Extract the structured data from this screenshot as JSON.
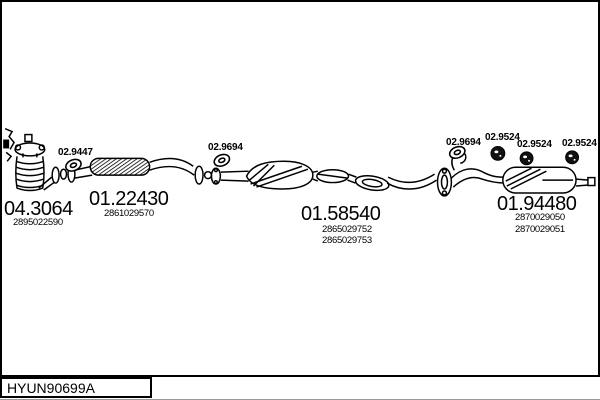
{
  "diagram_code": "HYUN90699A",
  "colors": {
    "line": "#000000",
    "background": "#ffffff"
  },
  "parts": {
    "catalyst": {
      "number": "04.3064",
      "oem": "2895022590"
    },
    "front_pipe": {
      "number": "01.22430",
      "oem": "2861029570"
    },
    "centre_silencer": {
      "number": "01.58540",
      "oem_a": "2865029752",
      "oem_b": "2865029753"
    },
    "rear_silencer": {
      "number": "01.94480",
      "oem_a": "2870029050",
      "oem_b": "2870029051"
    }
  },
  "fittings": {
    "gasket_front": "02.9447",
    "gasket_mid": "02.9694",
    "gasket_rear": "02.9694",
    "hanger_a": "02.9524",
    "hanger_b": "02.9524",
    "hanger_c": "02.9524"
  }
}
